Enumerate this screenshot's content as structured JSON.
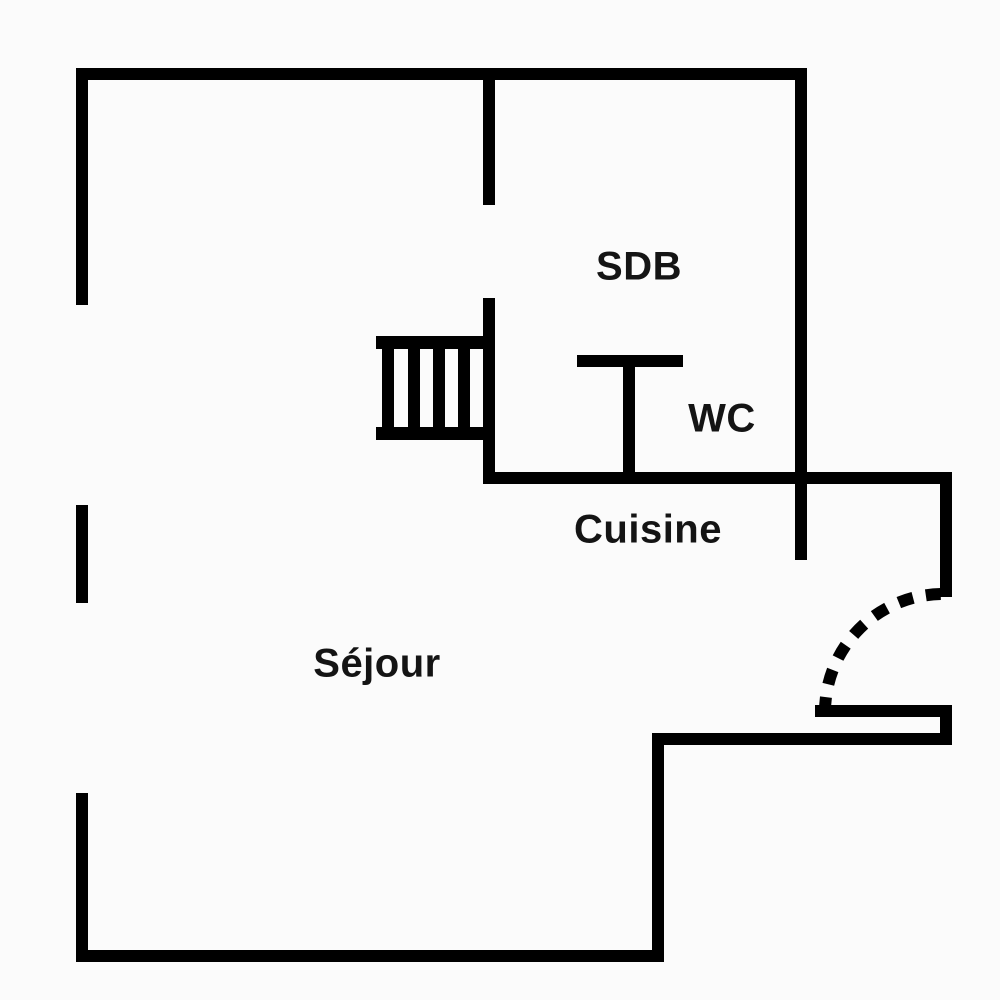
{
  "plan": {
    "type": "apartment-floor-plan",
    "colors": {
      "wall": "#000000",
      "background": "#fbfbfb",
      "label": "#141414"
    },
    "rooms": [
      {
        "label": "SDB"
      },
      {
        "label": "WC"
      },
      {
        "label": "Cuisine"
      },
      {
        "label": "Séjour"
      }
    ],
    "features": [
      {
        "name": "staircase",
        "steps": 4
      },
      {
        "name": "entry-door-swing",
        "style": "dashed-quarter-arc"
      },
      {
        "name": "window-openings-left-wall",
        "count": 2
      },
      {
        "name": "door-opening-stair-wall",
        "count": 1
      }
    ]
  }
}
